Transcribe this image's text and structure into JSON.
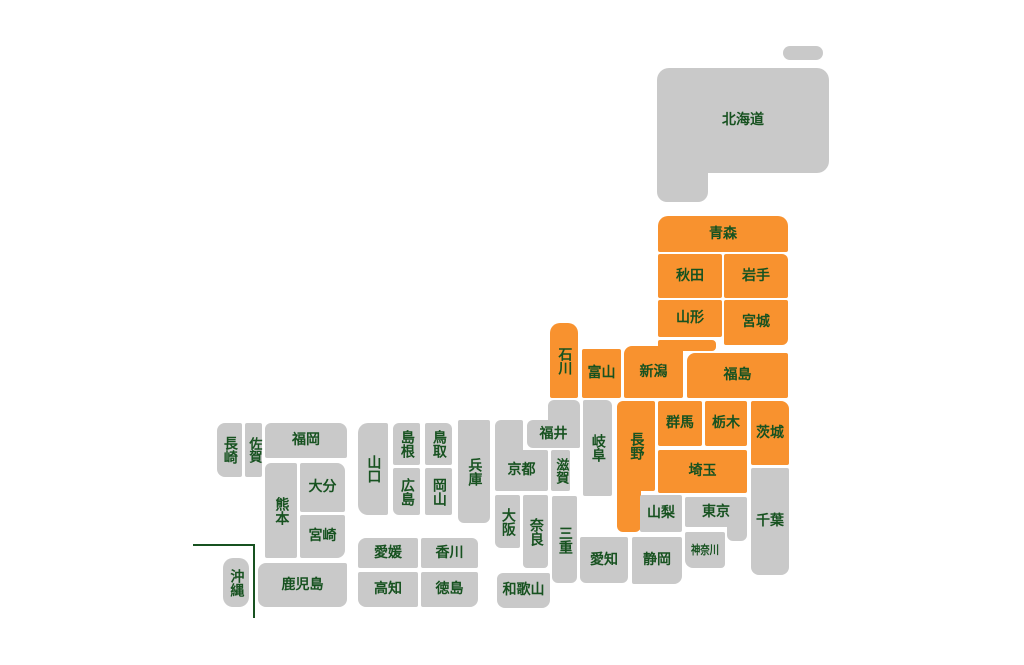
{
  "colors": {
    "active": "#f8922f",
    "inactive": "#c9c9c9",
    "label": "#175220",
    "background": "#ffffff"
  },
  "map": {
    "width": 1024,
    "height": 665,
    "okinawa_divider": {
      "horizontal": {
        "x": 193,
        "y": 544,
        "w": 62,
        "h": 2
      },
      "vertical": {
        "x": 253,
        "y": 544,
        "w": 2,
        "h": 74
      }
    },
    "prefectures": [
      {
        "id": "hokkaido",
        "name": "北海道",
        "status": "inactive",
        "vertical": false,
        "label_part": 1,
        "parts": [
          {
            "x": 783,
            "y": 46,
            "w": 40,
            "h": 14,
            "r": "7px"
          },
          {
            "x": 657,
            "y": 68,
            "w": 172,
            "h": 105,
            "r": "12px 12px 12px 0"
          },
          {
            "x": 657,
            "y": 160,
            "w": 51,
            "h": 42,
            "r": "0 0 10px 10px"
          }
        ]
      },
      {
        "id": "aomori",
        "name": "青森",
        "status": "active",
        "vertical": false,
        "parts": [
          {
            "x": 658,
            "y": 216,
            "w": 130,
            "h": 36,
            "r": "10px 10px 2px 2px"
          }
        ]
      },
      {
        "id": "akita",
        "name": "秋田",
        "status": "active",
        "vertical": false,
        "parts": [
          {
            "x": 658,
            "y": 254,
            "w": 64,
            "h": 44,
            "r": "2px"
          }
        ]
      },
      {
        "id": "iwate",
        "name": "岩手",
        "status": "active",
        "vertical": false,
        "parts": [
          {
            "x": 724,
            "y": 254,
            "w": 64,
            "h": 44,
            "r": "2px 6px 2px 2px"
          }
        ]
      },
      {
        "id": "yamagata",
        "name": "山形",
        "status": "active",
        "vertical": false,
        "parts": [
          {
            "x": 658,
            "y": 300,
            "w": 64,
            "h": 37,
            "r": "2px"
          }
        ]
      },
      {
        "id": "miyagi",
        "name": "宮城",
        "status": "active",
        "vertical": false,
        "parts": [
          {
            "x": 724,
            "y": 300,
            "w": 64,
            "h": 45,
            "r": "2px 2px 6px 2px"
          }
        ]
      },
      {
        "id": "fukushima",
        "name": "福島",
        "status": "active",
        "vertical": false,
        "parts": [
          {
            "x": 687,
            "y": 353,
            "w": 101,
            "h": 45,
            "r": "8px 2px 2px 2px"
          }
        ]
      },
      {
        "id": "niigata",
        "name": "新潟",
        "status": "active",
        "vertical": false,
        "label_part": 0,
        "parts": [
          {
            "x": 624,
            "y": 346,
            "w": 59,
            "h": 52,
            "r": "8px 2px 2px 2px"
          },
          {
            "x": 658,
            "y": 340,
            "w": 58,
            "h": 11,
            "r": "2px 4px 4px 2px"
          }
        ]
      },
      {
        "id": "toyama",
        "name": "富山",
        "status": "active",
        "vertical": false,
        "parts": [
          {
            "x": 582,
            "y": 349,
            "w": 39,
            "h": 49,
            "r": "2px"
          }
        ]
      },
      {
        "id": "ishikawa",
        "name": "石川",
        "status": "active",
        "vertical": true,
        "parts": [
          {
            "x": 550,
            "y": 323,
            "w": 28,
            "h": 75,
            "r": "10px 10px 2px 2px"
          }
        ]
      },
      {
        "id": "fukui",
        "name": "福井",
        "status": "inactive",
        "vertical": false,
        "label_part": 1,
        "parts": [
          {
            "x": 548,
            "y": 400,
            "w": 32,
            "h": 48,
            "r": "6px 6px 2px 2px"
          },
          {
            "x": 527,
            "y": 420,
            "w": 53,
            "h": 28,
            "r": "6px 2px 2px 6px"
          }
        ]
      },
      {
        "id": "nagano",
        "name": "長野",
        "status": "active",
        "vertical": true,
        "label_part": 0,
        "parts": [
          {
            "x": 617,
            "y": 401,
            "w": 38,
            "h": 90,
            "r": "6px 2px 2px 2px"
          },
          {
            "x": 617,
            "y": 480,
            "w": 24,
            "h": 52,
            "r": "2px 2px 6px 6px"
          }
        ]
      },
      {
        "id": "gunma",
        "name": "群馬",
        "status": "active",
        "vertical": false,
        "parts": [
          {
            "x": 658,
            "y": 401,
            "w": 44,
            "h": 45,
            "r": "2px"
          }
        ]
      },
      {
        "id": "tochigi",
        "name": "栃木",
        "status": "active",
        "vertical": false,
        "parts": [
          {
            "x": 705,
            "y": 401,
            "w": 42,
            "h": 45,
            "r": "2px"
          }
        ]
      },
      {
        "id": "ibaraki",
        "name": "茨城",
        "status": "active",
        "vertical": false,
        "parts": [
          {
            "x": 751,
            "y": 401,
            "w": 38,
            "h": 64,
            "r": "2px 8px 2px 2px"
          }
        ]
      },
      {
        "id": "saitama",
        "name": "埼玉",
        "status": "active",
        "vertical": false,
        "parts": [
          {
            "x": 658,
            "y": 450,
            "w": 89,
            "h": 43,
            "r": "2px"
          }
        ]
      },
      {
        "id": "chiba",
        "name": "千葉",
        "status": "inactive",
        "vertical": false,
        "parts": [
          {
            "x": 751,
            "y": 468,
            "w": 38,
            "h": 107,
            "r": "2px 2px 8px 8px"
          }
        ]
      },
      {
        "id": "tokyo",
        "name": "東京",
        "status": "inactive",
        "vertical": false,
        "label_part": 0,
        "parts": [
          {
            "x": 685,
            "y": 497,
            "w": 62,
            "h": 30,
            "r": "2px"
          },
          {
            "x": 727,
            "y": 522,
            "w": 20,
            "h": 19,
            "r": "2px 2px 6px 6px"
          }
        ]
      },
      {
        "id": "kanagawa",
        "name": "神奈川",
        "status": "inactive",
        "vertical": false,
        "compress": true,
        "fs": 12,
        "parts": [
          {
            "x": 685,
            "y": 532,
            "w": 40,
            "h": 36,
            "r": "2px 2px 4px 8px"
          }
        ]
      },
      {
        "id": "yamanashi",
        "name": "山梨",
        "status": "inactive",
        "vertical": false,
        "parts": [
          {
            "x": 640,
            "y": 495,
            "w": 42,
            "h": 37,
            "r": "2px"
          }
        ]
      },
      {
        "id": "shizuoka",
        "name": "静岡",
        "status": "inactive",
        "vertical": false,
        "parts": [
          {
            "x": 632,
            "y": 537,
            "w": 50,
            "h": 47,
            "r": "2px 2px 8px 2px"
          }
        ]
      },
      {
        "id": "aichi",
        "name": "愛知",
        "status": "inactive",
        "vertical": false,
        "parts": [
          {
            "x": 580,
            "y": 537,
            "w": 48,
            "h": 46,
            "r": "2px 2px 6px 6px"
          }
        ]
      },
      {
        "id": "gifu",
        "name": "岐阜",
        "status": "inactive",
        "vertical": true,
        "parts": [
          {
            "x": 583,
            "y": 400,
            "w": 29,
            "h": 96,
            "r": "2px 6px 2px 2px"
          }
        ]
      },
      {
        "id": "shiga",
        "name": "滋賀",
        "status": "inactive",
        "vertical": true,
        "fs": 13,
        "parts": [
          {
            "x": 551,
            "y": 450,
            "w": 19,
            "h": 41,
            "r": "2px"
          }
        ]
      },
      {
        "id": "kyoto",
        "name": "京都",
        "status": "inactive",
        "vertical": false,
        "label_part": 1,
        "parts": [
          {
            "x": 495,
            "y": 420,
            "w": 28,
            "h": 35,
            "r": "6px 2px 2px 2px"
          },
          {
            "x": 495,
            "y": 450,
            "w": 53,
            "h": 41,
            "r": "2px"
          }
        ]
      },
      {
        "id": "osaka",
        "name": "大阪",
        "status": "inactive",
        "vertical": true,
        "parts": [
          {
            "x": 495,
            "y": 495,
            "w": 25,
            "h": 53,
            "r": "2px 2px 2px 6px"
          }
        ]
      },
      {
        "id": "nara",
        "name": "奈良",
        "status": "inactive",
        "vertical": true,
        "parts": [
          {
            "x": 523,
            "y": 495,
            "w": 25,
            "h": 73,
            "r": "2px 2px 4px 4px"
          }
        ]
      },
      {
        "id": "mie",
        "name": "三重",
        "status": "inactive",
        "vertical": true,
        "parts": [
          {
            "x": 552,
            "y": 496,
            "w": 25,
            "h": 87,
            "r": "2px 2px 6px 6px"
          }
        ]
      },
      {
        "id": "wakayama",
        "name": "和歌山",
        "status": "inactive",
        "vertical": false,
        "parts": [
          {
            "x": 497,
            "y": 573,
            "w": 53,
            "h": 35,
            "r": "6px 2px 8px 8px"
          }
        ]
      },
      {
        "id": "hyogo",
        "name": "兵庫",
        "status": "inactive",
        "vertical": true,
        "parts": [
          {
            "x": 458,
            "y": 420,
            "w": 32,
            "h": 103,
            "r": "2px 2px 6px 6px"
          }
        ]
      },
      {
        "id": "tottori",
        "name": "鳥取",
        "status": "inactive",
        "vertical": true,
        "parts": [
          {
            "x": 425,
            "y": 423,
            "w": 27,
            "h": 42,
            "r": "2px 6px 2px 2px"
          }
        ]
      },
      {
        "id": "okayama",
        "name": "岡山",
        "status": "inactive",
        "vertical": true,
        "parts": [
          {
            "x": 425,
            "y": 468,
            "w": 27,
            "h": 47,
            "r": "2px"
          }
        ]
      },
      {
        "id": "shimane",
        "name": "島根",
        "status": "inactive",
        "vertical": true,
        "parts": [
          {
            "x": 393,
            "y": 423,
            "w": 27,
            "h": 42,
            "r": "6px 2px 2px 2px"
          }
        ]
      },
      {
        "id": "hiroshima",
        "name": "広島",
        "status": "inactive",
        "vertical": true,
        "parts": [
          {
            "x": 393,
            "y": 468,
            "w": 27,
            "h": 47,
            "r": "2px 2px 2px 6px"
          }
        ]
      },
      {
        "id": "yamaguchi",
        "name": "山口",
        "status": "inactive",
        "vertical": true,
        "parts": [
          {
            "x": 358,
            "y": 423,
            "w": 30,
            "h": 92,
            "r": "10px 2px 2px 10px"
          }
        ]
      },
      {
        "id": "kagawa",
        "name": "香川",
        "status": "inactive",
        "vertical": false,
        "parts": [
          {
            "x": 421,
            "y": 538,
            "w": 57,
            "h": 30,
            "r": "2px 6px 2px 2px"
          }
        ]
      },
      {
        "id": "ehime",
        "name": "愛媛",
        "status": "inactive",
        "vertical": false,
        "parts": [
          {
            "x": 358,
            "y": 538,
            "w": 60,
            "h": 30,
            "r": "8px 2px 2px 2px"
          }
        ]
      },
      {
        "id": "kochi",
        "name": "高知",
        "status": "inactive",
        "vertical": false,
        "parts": [
          {
            "x": 358,
            "y": 572,
            "w": 60,
            "h": 35,
            "r": "2px 2px 2px 8px"
          }
        ]
      },
      {
        "id": "tokushima",
        "name": "徳島",
        "status": "inactive",
        "vertical": false,
        "parts": [
          {
            "x": 421,
            "y": 572,
            "w": 57,
            "h": 35,
            "r": "2px 2px 8px 2px"
          }
        ]
      },
      {
        "id": "fukuoka",
        "name": "福岡",
        "status": "inactive",
        "vertical": false,
        "parts": [
          {
            "x": 265,
            "y": 423,
            "w": 82,
            "h": 35,
            "r": "6px 8px 2px 2px"
          }
        ]
      },
      {
        "id": "saga",
        "name": "佐賀",
        "status": "inactive",
        "vertical": true,
        "fs": 13,
        "parts": [
          {
            "x": 245,
            "y": 423,
            "w": 17,
            "h": 54,
            "r": "2px"
          }
        ]
      },
      {
        "id": "nagasaki",
        "name": "長崎",
        "status": "inactive",
        "vertical": true,
        "parts": [
          {
            "x": 217,
            "y": 423,
            "w": 25,
            "h": 54,
            "r": "8px 2px 2px 8px"
          }
        ]
      },
      {
        "id": "oita",
        "name": "大分",
        "status": "inactive",
        "vertical": false,
        "parts": [
          {
            "x": 300,
            "y": 463,
            "w": 45,
            "h": 49,
            "r": "2px 8px 2px 2px"
          }
        ]
      },
      {
        "id": "kumamoto",
        "name": "熊本",
        "status": "inactive",
        "vertical": true,
        "parts": [
          {
            "x": 265,
            "y": 463,
            "w": 32,
            "h": 95,
            "r": "6px 2px 2px 2px"
          }
        ]
      },
      {
        "id": "miyazaki",
        "name": "宮崎",
        "status": "inactive",
        "vertical": false,
        "parts": [
          {
            "x": 300,
            "y": 515,
            "w": 45,
            "h": 43,
            "r": "2px 2px 8px 2px"
          }
        ]
      },
      {
        "id": "kagoshima",
        "name": "鹿児島",
        "status": "inactive",
        "vertical": false,
        "parts": [
          {
            "x": 258,
            "y": 563,
            "w": 89,
            "h": 44,
            "r": "8px 2px 8px 8px"
          }
        ]
      },
      {
        "id": "okinawa",
        "name": "沖縄",
        "status": "inactive",
        "vertical": true,
        "parts": [
          {
            "x": 223,
            "y": 558,
            "w": 26,
            "h": 49,
            "r": "10px"
          }
        ]
      }
    ]
  }
}
